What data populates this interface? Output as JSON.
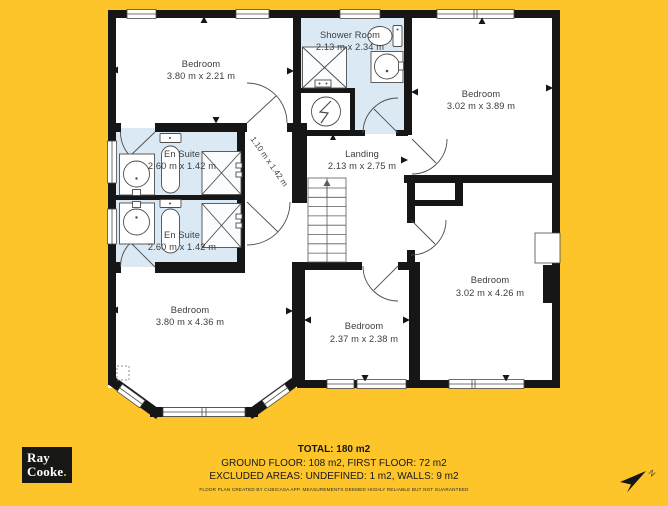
{
  "colors": {
    "background": "#FEC52B",
    "wall": "#161616",
    "floor": "#FFFFFF",
    "bathroom_floor": "#DBE9F4",
    "label_text": "#3D3D3D",
    "footer_text": "#171717",
    "logo_bg": "#171716",
    "logo_text": "#FFFFFF",
    "logo_dot": "#F5A81C"
  },
  "rooms": {
    "bedroom_top_left": {
      "name": "Bedroom",
      "dims": "3.80 m x 2.21 m"
    },
    "shower_room": {
      "name": "Shower Room",
      "dims": "2.13 m x 2.34 m",
      "fixtures": [
        "shower",
        "toilet",
        "sink",
        "water-heater"
      ]
    },
    "bedroom_top_right": {
      "name": "Bedroom",
      "dims": "3.02 m x 3.89 m"
    },
    "en_suite_top": {
      "name": "En Suite",
      "dims": "2.60 m x 1.42 m",
      "fixtures": [
        "sink",
        "toilet",
        "shower"
      ]
    },
    "en_suite_bottom": {
      "name": "En Suite",
      "dims": "2.60 m x 1.42 m",
      "fixtures": [
        "sink",
        "toilet",
        "shower"
      ]
    },
    "hallway": {
      "dims": "1.10 m x 1.42 m"
    },
    "landing": {
      "name": "Landing",
      "dims": "2.13 m x 2.75 m",
      "fixtures": [
        "stairs-up"
      ]
    },
    "bedroom_bottom_left": {
      "name": "Bedroom",
      "dims": "3.80 m x 4.36 m"
    },
    "bedroom_bottom_middle": {
      "name": "Bedroom",
      "dims": "2.37 m x 2.38 m"
    },
    "bedroom_right": {
      "name": "Bedroom",
      "dims": "3.02 m x 4.26 m"
    }
  },
  "footer": {
    "total": "TOTAL: 180 m2",
    "floors": "GROUND FLOOR: 108 m2, FIRST FLOOR: 72 m2",
    "excluded": "EXCLUDED AREAS: UNDEFINED: 1 m2, WALLS: 9 m2",
    "disclaimer": "FLOOR PLAN CREATED BY CUBICASA APP. MEASUREMENTS DEEMED HIGHLY RELIABLE BUT NOT GUARANTEED"
  },
  "logo": {
    "line1": "Ray",
    "line2": "Cooke",
    "period": "."
  },
  "compass": {
    "label": "N"
  }
}
